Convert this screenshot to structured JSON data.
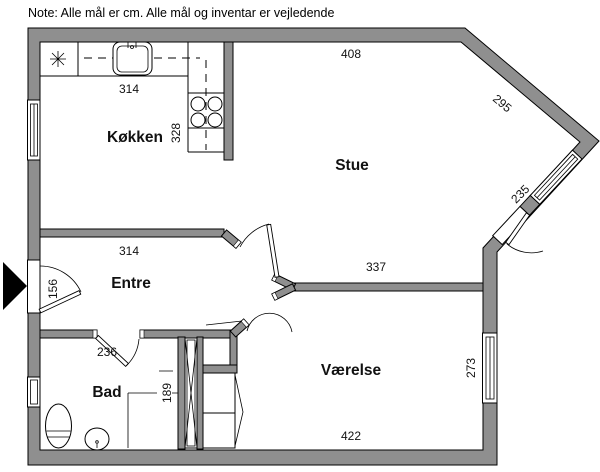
{
  "note": "Note: Alle mål er cm. Alle mål og inventar er vejledende",
  "colors": {
    "wall": "#8f8f8f",
    "outline": "#000000",
    "floor": "#ffffff",
    "text": "#111111"
  },
  "rooms": {
    "kitchen": {
      "name": "Køkken"
    },
    "living": {
      "name": "Stue"
    },
    "hall": {
      "name": "Entre"
    },
    "bath": {
      "name": "Bad"
    },
    "bedroom": {
      "name": "Værelse"
    }
  },
  "dimensions_cm": {
    "top_wall": "408",
    "upper_diagonal": "295",
    "diagonal_window": "235",
    "kitchen_width": "314",
    "kitchen_depth": "328",
    "hall_width": "314",
    "entry_door": "156",
    "stue_vaerelse_wall": "337",
    "bath_width": "236",
    "bath_niche": "189",
    "bedroom_depth": "273",
    "bedroom_width": "422"
  },
  "fixtures": [
    "cooktop-star",
    "kitchen-sink",
    "stove-4-burners",
    "toilet",
    "washbasin",
    "vent-shaft",
    "wardrobe"
  ]
}
